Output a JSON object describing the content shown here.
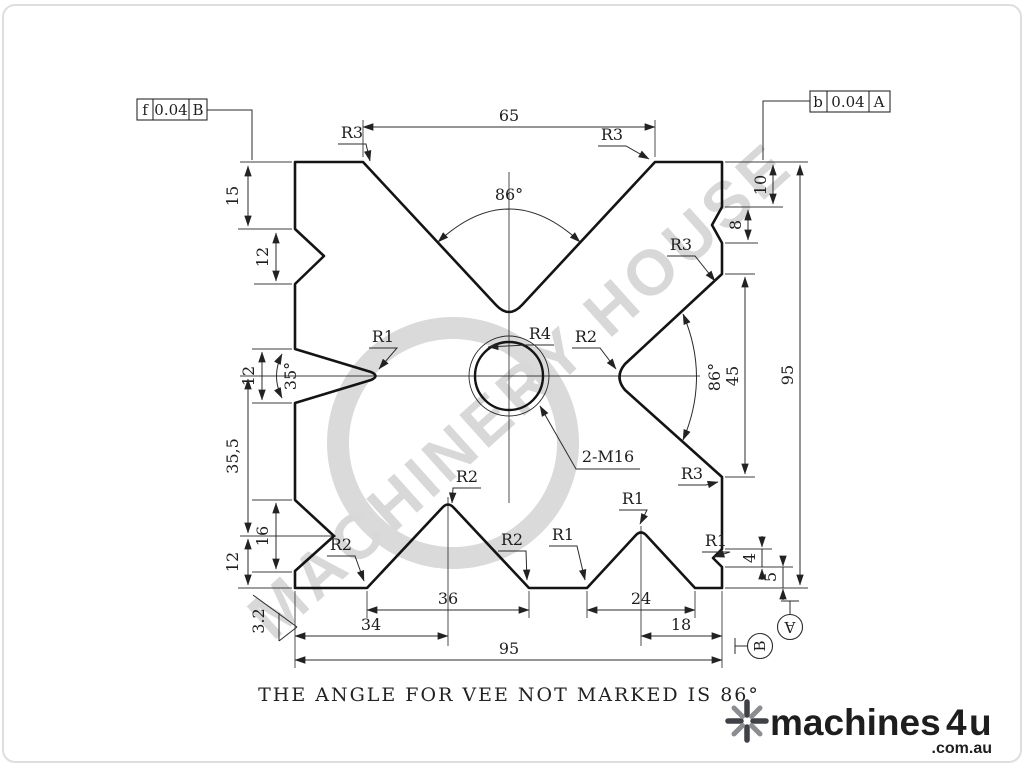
{
  "colors": {
    "line": "#141414",
    "dimension": "#2b2b2b",
    "watermark": "#d8d8d8",
    "logo_gray": "#9b9b9b",
    "logo_dark": "#3f4147"
  },
  "watermark": {
    "text": "MACHINERY HOUSE"
  },
  "tolerance_left": {
    "symbol": "f",
    "value": "0.04",
    "datum": "B"
  },
  "tolerance_right": {
    "symbol": "b",
    "value": "0.04",
    "datum": "A"
  },
  "dims": {
    "top_width": "65",
    "angle_top": "86°",
    "angle_right": "86°",
    "angle_left_vee": "35°",
    "left_top_offset": "15",
    "left_top_vee": "12",
    "left_mid_vee": "12",
    "left_span": "35,5",
    "left_bottom_vee": "16",
    "left_bottom_offset": "12",
    "right_top_offset": "10",
    "right_top_vee": "8",
    "right_vee_span": "45",
    "right_height": "95",
    "right_notch": "4",
    "right_notch_offset": "5",
    "bottom_vee_36": "36",
    "bottom_vee_24": "24",
    "bottom_left_span": "34",
    "bottom_right_span": "18",
    "bottom_width": "95"
  },
  "radii": {
    "r3_top_left": "R3",
    "r3_top_right": "R3",
    "r3_right_upper": "R3",
    "r3_right_lower": "R3",
    "r4_apex": "R4",
    "r2_right_apex": "R2",
    "r1_left_vee": "R1",
    "r2_bottom_left": "R2",
    "r2_vee36_apex": "R2",
    "r2_vee36_right": "R2",
    "r1_vee24_left": "R1",
    "r1_vee24_apex": "R1",
    "r1_notch": "R1",
    "thread_callout": "2-M16",
    "roughness": "3.2"
  },
  "datums": {
    "a": "A",
    "b": "B"
  },
  "note": {
    "text": "THE ANGLE FOR VEE NOT MARKED IS 86°"
  },
  "logo": {
    "brand": "machines",
    "number": "4",
    "suffix": "u",
    "domain": ".com.au"
  }
}
